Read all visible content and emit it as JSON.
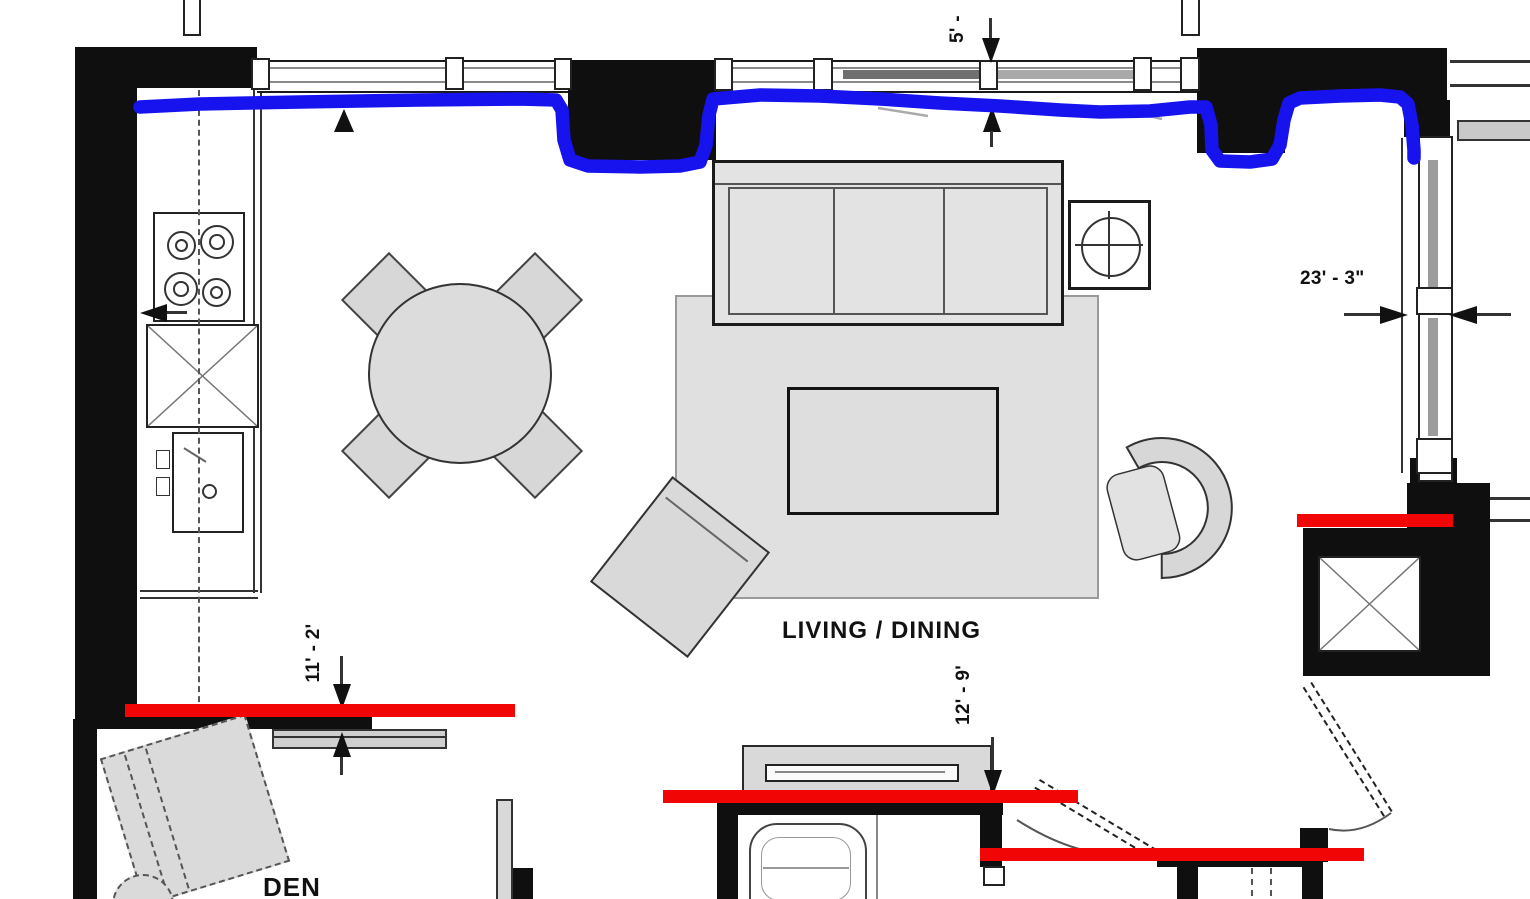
{
  "plan": {
    "room_labels": {
      "living_dining": "LIVING / DINING",
      "den": "DEN"
    },
    "dimension_labels": {
      "top_window_partial": "5' -",
      "right_window_width": "23' - 3\"",
      "kitchen_den_width": "11' - 2'",
      "living_width": "12' - 9'"
    },
    "annotation_colors": {
      "blue_highlight": "#1713ee",
      "red_highlight": "#f20505"
    }
  }
}
